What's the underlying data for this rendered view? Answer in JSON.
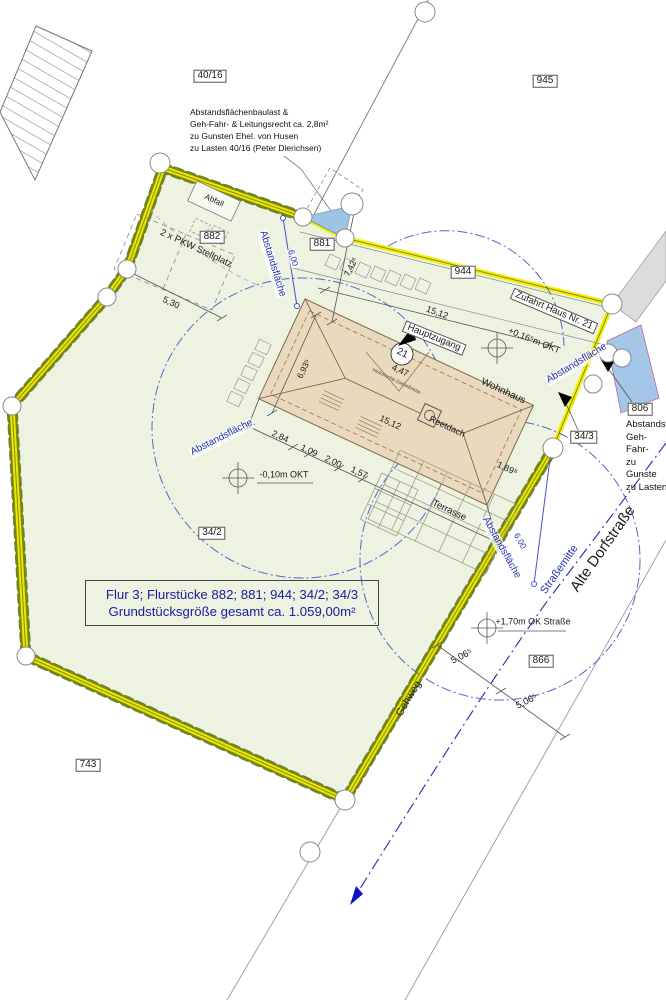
{
  "parcels": {
    "p40_16": "40/16",
    "p945": "945",
    "p882": "882",
    "p881": "881",
    "p944": "944",
    "p34_2": "34/2",
    "p34_3": "34/3",
    "p806": "806",
    "p866": "866",
    "p743": "743"
  },
  "easement_note_top": {
    "line1": "Abstandsflächenbaulast &",
    "line2": "Geh-Fahr- & Leitungsrecht  ca. 2,8m²",
    "line3": "zu Gunsten Ehel. von Husen",
    "line4": "zu Lasten 40/16 (Peter Dierichsen)"
  },
  "easement_note_right": {
    "line1": "Abstandsf",
    "line2": "Geh-Fahr-",
    "line3": "zu Gunste",
    "line4": "zu Lasten"
  },
  "labels": {
    "abfall": "Abfall",
    "stellplatz": "2 x PKW Stellplatz",
    "zufahrt": "Zufahrt Haus Nr. 21",
    "hauptzugang": "Hauptzugang",
    "haus_nummer": "21",
    "wohnhaus": "Wohnhaus",
    "reetdach": "Reetdach",
    "giebel": "Historische Giebelbreite",
    "terrasse": "Terrasse",
    "abstandsflaeche": "Abstandsfläche",
    "gehweg": "Gehweg",
    "strassenmitte": "Straßemitte",
    "strasse": "Alte Dorfstraße"
  },
  "dims": {
    "d_530": "5,30",
    "d_742": "7,42⁶",
    "d_600": "6,00",
    "d_1512": "15,12",
    "d_693": "6,93⁵",
    "d_447": "4,47",
    "d_284": "2,84",
    "d_109": "1,09",
    "d_200": "2,00",
    "d_157": "1,57",
    "d_189": "1,89⁸",
    "d_506": "5,06⁵"
  },
  "levels": {
    "okt_plus": "+0,16⁵m OKT",
    "okt_minus": "-0,10m OKT",
    "ok_strasse": "+1,70m OK Straße"
  },
  "info_box": {
    "line1": "Flur 3;  Flurstücke 882; 881; 944; 34/2; 34/3",
    "line2": "Grundstücksgröße gesamt ca. 1.059,00m²"
  },
  "colors": {
    "boundary_yellow": "#f2ee00",
    "vegetation_olive": "#6d7c15",
    "parcel_fill": "#edf2e1",
    "house_fill": "#ead9bc",
    "abstandsflaeche_blue": "#2230b5",
    "water_blue": "#9ec4e4",
    "road_gray": "#dcdcdc",
    "info_text_blue": "#1b1ba0"
  }
}
